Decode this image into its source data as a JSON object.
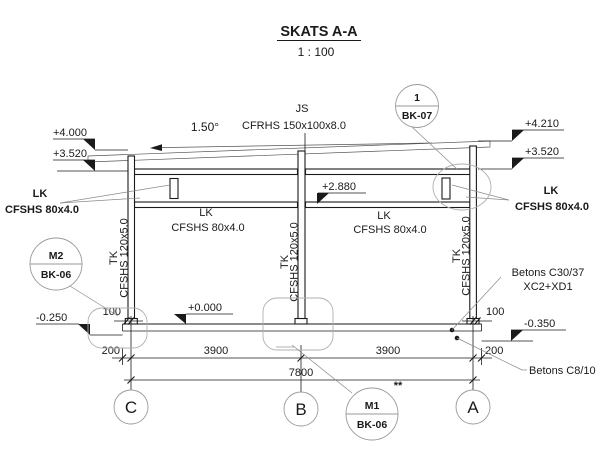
{
  "title": {
    "heading": "SKATS A-A",
    "scale": "1 : 100"
  },
  "roof": {
    "slope": "1.50°",
    "beam_label_top": "JS",
    "beam_label_bottom": "CFRHS 150x100x8.0"
  },
  "labels": {
    "lk_left_margin": {
      "line1": "LK",
      "line2": "CFSHS 80x4.0"
    },
    "lk_right_margin": {
      "line1": "LK",
      "line2": "CFSHS 80x4.0"
    },
    "lk_bay_left": {
      "line1": "LK",
      "line2": "CFSHS 80x4.0"
    },
    "lk_bay_right": {
      "line1": "LK",
      "line2": "CFSHS 80x4.0"
    },
    "tk_col_c": {
      "line1": "TK",
      "line2": "CFSHS 120x5.0"
    },
    "tk_col_b": {
      "line1": "TK",
      "line2": "CFSHS 120x5.0"
    },
    "tk_col_a": {
      "line1": "TK",
      "line2": "CFSHS 120x5.0"
    },
    "concrete_main_1": "Betons C30/37",
    "concrete_main_2": "XC2+XD1",
    "concrete_lean": "Betons C8/10",
    "footnote": "**"
  },
  "levels": {
    "left_top": "+4.000",
    "left_mid": "+3.520",
    "right_top": "+4.210",
    "right_mid": "+3.520",
    "mid_rail": "+2.880",
    "floor": "+0.000",
    "found_left": "-0.250",
    "found_right": "-0.350"
  },
  "dimensions": {
    "plate_left": "100",
    "plate_right": "100",
    "edge_left": "200",
    "edge_right": "200",
    "bay_left": "3900",
    "bay_right": "3900",
    "total": "7800"
  },
  "balloons": {
    "bk07": {
      "top": "1",
      "bottom": "BK-07"
    },
    "m2": {
      "top": "M2",
      "bottom": "BK-06"
    },
    "m1": {
      "top": "M1",
      "bottom": "BK-06"
    }
  },
  "grid": {
    "c": "C",
    "b": "B",
    "a": "A"
  }
}
